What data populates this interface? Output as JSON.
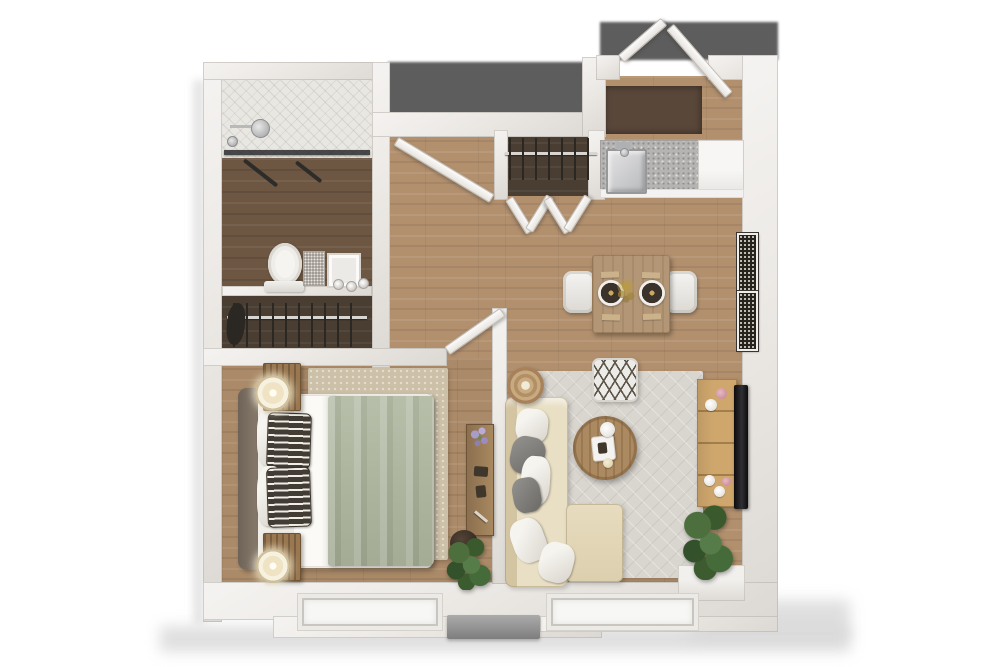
{
  "canvas": {
    "width": 1000,
    "height": 667,
    "background": "#ffffff"
  },
  "plan_type": "one-bedroom-apartment-3d-floor-plan",
  "rooms": [
    "bathroom",
    "bathroom-closet",
    "hallway",
    "entry",
    "kitchen",
    "dining-area",
    "living-room",
    "bedroom",
    "coat-closet"
  ],
  "palette": {
    "wall": "#eae7e3",
    "floor_wood": "#b2906e",
    "floor_wood_dark": "#6d5743",
    "closet_floor": "#4a3e33",
    "shower_tile": "#e9e7e2",
    "exterior_shadow": "#5d5d5d",
    "rug_living": "#d9d5cf",
    "rug_bedroom": "#cdc0a8",
    "sofa_cream": "#e9dfc4",
    "duvet_sage": "#adb59d",
    "console_tan": "#cfa76d",
    "plant_green": "#4d6f3e",
    "accent_pink": "#c2808f",
    "granite_counter": "#b6b4b2",
    "tv_black": "#0c0c0d"
  },
  "items": [
    {
      "n": "building-shadow-bottom",
      "t": "soft",
      "x": 160,
      "y": 626,
      "w": 690,
      "h": 26
    },
    {
      "n": "building-shadow-right",
      "t": "soft",
      "x": 690,
      "y": 600,
      "w": 160,
      "h": 40
    },
    {
      "n": "building-shadow-left",
      "t": "soft2",
      "x": 193,
      "y": 80,
      "w": 12,
      "h": 545
    },
    {
      "n": "exterior-shadow-notch",
      "t": "shadow-dark",
      "x": 388,
      "y": 62,
      "w": 212,
      "h": 53
    },
    {
      "n": "exterior-shadow-entry",
      "t": "shadow-dark",
      "x": 600,
      "y": 22,
      "w": 178,
      "h": 38
    },
    {
      "n": "hallway-floor",
      "t": "wood",
      "x": 372,
      "y": 130,
      "w": 138,
      "h": 238
    },
    {
      "n": "living-room-floor",
      "t": "wood",
      "x": 505,
      "y": 130,
      "w": 240,
      "h": 472
    },
    {
      "n": "entry-floor",
      "t": "wood",
      "x": 600,
      "y": 76,
      "w": 144,
      "h": 66
    },
    {
      "n": "entry-doormat",
      "t": "mat",
      "x": 604,
      "y": 86,
      "w": 98,
      "h": 48
    },
    {
      "n": "bedroom-floor",
      "t": "wood2",
      "x": 222,
      "y": 358,
      "w": 275,
      "h": 240
    },
    {
      "n": "shower-floor",
      "t": "tile",
      "x": 222,
      "y": 76,
      "w": 150,
      "h": 82
    },
    {
      "n": "bathroom-floor",
      "t": "woodDark",
      "x": 222,
      "y": 158,
      "w": 150,
      "h": 132
    },
    {
      "n": "bathroom-closet-floor",
      "t": "darkfloor",
      "x": 222,
      "y": 294,
      "w": 150,
      "h": 62
    },
    {
      "n": "coat-closet-floor",
      "t": "darkfloor",
      "x": 497,
      "y": 130,
      "w": 103,
      "h": 66
    },
    {
      "n": "living-rug",
      "t": "rug-gray",
      "x": 515,
      "y": 371,
      "w": 188,
      "h": 207
    },
    {
      "n": "bedroom-rug",
      "t": "rug-beige",
      "x": 308,
      "y": 368,
      "w": 140,
      "h": 192
    },
    {
      "n": "wall-left",
      "t": "wall",
      "x": 203,
      "y": 62,
      "w": 19,
      "h": 560
    },
    {
      "n": "wall-top-bathroom",
      "t": "wall",
      "x": 203,
      "y": 62,
      "w": 187,
      "h": 18
    },
    {
      "n": "wall-bathroom-right",
      "t": "wall",
      "x": 372,
      "y": 62,
      "w": 18,
      "h": 306
    },
    {
      "n": "wall-bathroom-closet-divider",
      "t": "wall",
      "x": 222,
      "y": 286,
      "w": 150,
      "h": 10
    },
    {
      "n": "wall-bedroom-top",
      "t": "wall",
      "x": 203,
      "y": 348,
      "w": 244,
      "h": 18
    },
    {
      "n": "wall-hallway-top",
      "t": "wall",
      "x": 372,
      "y": 112,
      "w": 230,
      "h": 25
    },
    {
      "n": "wall-entry-left",
      "t": "wall",
      "x": 582,
      "y": 57,
      "w": 24,
      "h": 80
    },
    {
      "n": "wall-entry-top-a",
      "t": "wall",
      "x": 596,
      "y": 55,
      "w": 24,
      "h": 25
    },
    {
      "n": "wall-entry-top-b",
      "t": "wall",
      "x": 708,
      "y": 55,
      "w": 70,
      "h": 25
    },
    {
      "n": "wall-right",
      "t": "wall",
      "x": 742,
      "y": 55,
      "w": 36,
      "h": 567
    },
    {
      "n": "wall-bottom",
      "t": "wall",
      "x": 203,
      "y": 582,
      "w": 575,
      "h": 38
    },
    {
      "n": "wall-bottom-ext-mid",
      "t": "wall",
      "x": 273,
      "y": 616,
      "w": 329,
      "h": 22
    },
    {
      "n": "wall-bottom-ext-right",
      "t": "wall",
      "x": 540,
      "y": 616,
      "w": 238,
      "h": 16
    },
    {
      "n": "wall-partition-bedroom-living",
      "t": "wall",
      "x": 492,
      "y": 308,
      "w": 15,
      "h": 276
    },
    {
      "n": "wall-coat-closet-left",
      "t": "wall",
      "x": 494,
      "y": 130,
      "w": 14,
      "h": 70
    },
    {
      "n": "wall-coat-closet-right",
      "t": "wall",
      "x": 588,
      "y": 130,
      "w": 17,
      "h": 70
    },
    {
      "n": "shower-glass-panel",
      "t": "glass-dark",
      "x": 224,
      "y": 150,
      "w": 146,
      "h": 5
    },
    {
      "n": "shower-squeegee-a",
      "t": "bar-dark",
      "x": 244,
      "y": 158,
      "w": 42,
      "h": 4,
      "r": 38
    },
    {
      "n": "shower-squeegee-b",
      "t": "bar-dark",
      "x": 296,
      "y": 160,
      "w": 32,
      "h": 4,
      "r": 38
    },
    {
      "n": "shower-arm",
      "t": "steel-line",
      "x": 230,
      "y": 125,
      "w": 26,
      "h": 3
    },
    {
      "n": "shower-head",
      "t": "steel-round",
      "x": 251,
      "y": 119,
      "w": 17,
      "h": 17
    },
    {
      "n": "shower-valve",
      "t": "steel-round",
      "x": 227,
      "y": 136,
      "w": 9,
      "h": 9
    },
    {
      "n": "toilet-bowl",
      "t": "toilet-bowl",
      "x": 268,
      "y": 243,
      "w": 34,
      "h": 42
    },
    {
      "n": "toilet-tank",
      "t": "toilet-tank",
      "x": 264,
      "y": 281,
      "w": 40,
      "h": 11
    },
    {
      "n": "vanity-mirror",
      "t": "sparkle",
      "x": 303,
      "y": 251,
      "w": 20,
      "h": 33
    },
    {
      "n": "vanity-frame",
      "t": "frame-white",
      "x": 327,
      "y": 253,
      "w": 30,
      "h": 31
    },
    {
      "n": "sink-knob-1",
      "t": "knob",
      "x": 333,
      "y": 279,
      "w": 9,
      "h": 9
    },
    {
      "n": "sink-knob-2",
      "t": "knob",
      "x": 346,
      "y": 281,
      "w": 9,
      "h": 9
    },
    {
      "n": "sink-knob-3",
      "t": "knob",
      "x": 358,
      "y": 278,
      "w": 9,
      "h": 9
    },
    {
      "n": "bathroom-closet-rod",
      "t": "rod",
      "x": 227,
      "y": 316,
      "w": 140,
      "h": 3
    },
    {
      "n": "bathroom-closet-hangers",
      "t": "hangers",
      "x": 233,
      "y": 303,
      "w": 128,
      "h": 44
    },
    {
      "n": "bathroom-closet-clothes",
      "t": "clothes-dark",
      "x": 227,
      "y": 302,
      "w": 18,
      "h": 42,
      "r": 6
    },
    {
      "n": "coat-closet-rod",
      "t": "rod",
      "x": 505,
      "y": 152,
      "w": 92,
      "h": 3
    },
    {
      "n": "coat-closet-hangers",
      "t": "hangers",
      "x": 509,
      "y": 138,
      "w": 86,
      "h": 42
    },
    {
      "n": "bifold-door-a1",
      "t": "door",
      "x": 509,
      "y": 194,
      "w": 38,
      "h": 7,
      "r": 58
    },
    {
      "n": "bifold-door-a2",
      "t": "door",
      "x": 529,
      "y": 226,
      "w": 38,
      "h": 7,
      "r": -58
    },
    {
      "n": "bifold-door-b1",
      "t": "door",
      "x": 547,
      "y": 194,
      "w": 38,
      "h": 7,
      "r": 58
    },
    {
      "n": "bifold-door-b2",
      "t": "door",
      "x": 567,
      "y": 226,
      "w": 38,
      "h": 7,
      "r": -58
    },
    {
      "n": "kitchen-counter-granite",
      "t": "granite",
      "x": 600,
      "y": 140,
      "w": 100,
      "h": 54
    },
    {
      "n": "kitchen-cabinet-white",
      "t": "cab-white",
      "x": 698,
      "y": 140,
      "w": 44,
      "h": 54
    },
    {
      "n": "kitchen-counter-lip",
      "t": "lip",
      "x": 600,
      "y": 189,
      "w": 142,
      "h": 7
    },
    {
      "n": "kitchen-sink",
      "t": "sink",
      "x": 606,
      "y": 149,
      "w": 37,
      "h": 41
    },
    {
      "n": "kitchen-faucet",
      "t": "faucet",
      "x": 616,
      "y": 142,
      "w": 14,
      "h": 8
    },
    {
      "n": "kitchen-faucet-knob",
      "t": "steel-round",
      "x": 620,
      "y": 148,
      "w": 7,
      "h": 7
    },
    {
      "n": "entry-door-left",
      "t": "door",
      "x": 621,
      "y": 54,
      "w": 55,
      "h": 8,
      "r": -41
    },
    {
      "n": "entry-door-right",
      "t": "door",
      "x": 670,
      "y": 22,
      "w": 88,
      "h": 8,
      "r": 49
    },
    {
      "n": "bathroom-door",
      "t": "door",
      "x": 396,
      "y": 136,
      "w": 110,
      "h": 8,
      "r": 31
    },
    {
      "n": "bedroom-door",
      "t": "door",
      "x": 447,
      "y": 346,
      "w": 66,
      "h": 8,
      "r": -35
    },
    {
      "n": "dining-chair-left",
      "t": "chair",
      "x": 563,
      "y": 271,
      "w": 32,
      "h": 42
    },
    {
      "n": "dining-chair-right",
      "t": "chair",
      "x": 665,
      "y": 271,
      "w": 32,
      "h": 42
    },
    {
      "n": "dining-table",
      "t": "table-wood",
      "x": 592,
      "y": 255,
      "w": 78,
      "h": 78
    },
    {
      "n": "placemat-1",
      "t": "placemat",
      "x": 601,
      "y": 272,
      "w": 18,
      "h": 6,
      "r": -2
    },
    {
      "n": "placemat-2",
      "t": "placemat",
      "x": 642,
      "y": 272,
      "w": 18,
      "h": 6,
      "r": 2
    },
    {
      "n": "placemat-3",
      "t": "placemat",
      "x": 602,
      "y": 314,
      "w": 18,
      "h": 6,
      "r": 2
    },
    {
      "n": "placemat-4",
      "t": "placemat",
      "x": 643,
      "y": 314,
      "w": 18,
      "h": 6,
      "r": -2
    },
    {
      "n": "dinner-plate-1",
      "t": "plate",
      "x": 598,
      "y": 280,
      "w": 26,
      "h": 26
    },
    {
      "n": "dinner-plate-2",
      "t": "plate",
      "x": 639,
      "y": 280,
      "w": 26,
      "h": 26
    },
    {
      "n": "table-centerpiece",
      "t": "sprig",
      "x": 616,
      "y": 277,
      "w": 20,
      "h": 28
    },
    {
      "n": "wall-art-upper",
      "t": "art",
      "x": 737,
      "y": 233,
      "w": 17,
      "h": 55
    },
    {
      "n": "wall-art-lower",
      "t": "art",
      "x": 737,
      "y": 291,
      "w": 17,
      "h": 56
    },
    {
      "n": "floor-pouf",
      "t": "pouf",
      "x": 592,
      "y": 358,
      "w": 42,
      "h": 40
    },
    {
      "n": "sofa-base",
      "t": "sofa",
      "x": 505,
      "y": 397,
      "w": 63,
      "h": 190
    },
    {
      "n": "sofa-chaise",
      "t": "chaise",
      "x": 566,
      "y": 504,
      "w": 57,
      "h": 78
    },
    {
      "n": "side-table",
      "t": "side-table",
      "x": 507,
      "y": 367,
      "w": 37,
      "h": 37
    },
    {
      "n": "sofa-pillow-white-1",
      "t": "pillow-white",
      "x": 516,
      "y": 407,
      "w": 32,
      "h": 34,
      "r": 6
    },
    {
      "n": "sofa-pillow-gray-1",
      "t": "pillow-gray",
      "x": 511,
      "y": 433,
      "w": 34,
      "h": 38,
      "r": 12
    },
    {
      "n": "sofa-pillow-white-2",
      "t": "pillow-white",
      "x": 521,
      "y": 455,
      "w": 29,
      "h": 49,
      "r": 4
    },
    {
      "n": "sofa-pillow-gray-2",
      "t": "pillow-gray",
      "x": 513,
      "y": 480,
      "w": 28,
      "h": 35,
      "r": -10
    },
    {
      "n": "sofa-pillow-white-3",
      "t": "pillow-white",
      "x": 513,
      "y": 524,
      "w": 33,
      "h": 44,
      "r": -20
    },
    {
      "n": "sofa-pillow-white-4",
      "t": "pillow-white",
      "x": 540,
      "y": 538,
      "w": 34,
      "h": 40,
      "r": 15
    },
    {
      "n": "coffee-table",
      "t": "coffee",
      "x": 573,
      "y": 416,
      "w": 64,
      "h": 64
    },
    {
      "n": "coffee-table-tray",
      "t": "tray",
      "x": 592,
      "y": 437,
      "w": 21,
      "h": 23,
      "r": -6
    },
    {
      "n": "tray-teapot",
      "t": "item-dark",
      "x": 598,
      "y": 443,
      "w": 9,
      "h": 11,
      "r": -6
    },
    {
      "n": "coffee-table-plate",
      "t": "circle-white",
      "x": 600,
      "y": 422,
      "w": 15,
      "h": 15
    },
    {
      "n": "coffee-table-candle",
      "t": "circle-cream",
      "x": 603,
      "y": 458,
      "w": 10,
      "h": 10
    },
    {
      "n": "media-console",
      "t": "console",
      "x": 697,
      "y": 379,
      "w": 38,
      "h": 126
    },
    {
      "n": "tv",
      "t": "tv",
      "x": 734,
      "y": 385,
      "w": 14,
      "h": 124
    },
    {
      "n": "console-vase-pink-1",
      "t": "deco-pink",
      "x": 716,
      "y": 388,
      "w": 11,
      "h": 11
    },
    {
      "n": "console-bowl-white",
      "t": "circle-white",
      "x": 705,
      "y": 399,
      "w": 12,
      "h": 12
    },
    {
      "n": "console-orb-white-1",
      "t": "circle-white",
      "x": 704,
      "y": 475,
      "w": 11,
      "h": 11
    },
    {
      "n": "console-orb-white-2",
      "t": "circle-white",
      "x": 714,
      "y": 486,
      "w": 11,
      "h": 11
    },
    {
      "n": "console-vase-pink-2",
      "t": "deco-pink",
      "x": 722,
      "y": 477,
      "w": 9,
      "h": 9
    },
    {
      "n": "corner-ledge",
      "t": "ledge",
      "x": 678,
      "y": 565,
      "w": 67,
      "h": 36
    },
    {
      "n": "living-plant",
      "t": "plant",
      "x": 682,
      "y": 504,
      "w": 52,
      "h": 76
    },
    {
      "n": "bed-headboard",
      "t": "headboard",
      "x": 238,
      "y": 388,
      "w": 24,
      "h": 182
    },
    {
      "n": "bed-mattress",
      "t": "mattress",
      "x": 258,
      "y": 394,
      "w": 174,
      "h": 174
    },
    {
      "n": "bed-sheet",
      "t": "sheet",
      "x": 294,
      "y": 396,
      "w": 42,
      "h": 170
    },
    {
      "n": "bed-duvet",
      "t": "duvet",
      "x": 328,
      "y": 396,
      "w": 106,
      "h": 170
    },
    {
      "n": "bed-pillow-white-1",
      "t": "pillow-white",
      "x": 257,
      "y": 408,
      "w": 26,
      "h": 58
    },
    {
      "n": "bed-pillow-striped-1",
      "t": "pillow-stripe",
      "x": 267,
      "y": 412,
      "w": 42,
      "h": 54,
      "r": 2
    },
    {
      "n": "bed-pillow-white-2",
      "t": "pillow-white",
      "x": 257,
      "y": 466,
      "w": 26,
      "h": 60
    },
    {
      "n": "bed-pillow-striped-2",
      "t": "pillow-stripe",
      "x": 267,
      "y": 468,
      "w": 42,
      "h": 58,
      "r": -2
    },
    {
      "n": "nightstand-upper",
      "t": "nightstand",
      "x": 263,
      "y": 363,
      "w": 36,
      "h": 46
    },
    {
      "n": "table-lamp-upper",
      "t": "lamp",
      "x": 255,
      "y": 375,
      "w": 36,
      "h": 36
    },
    {
      "n": "nightstand-lower",
      "t": "nightstand",
      "x": 263,
      "y": 533,
      "w": 36,
      "h": 46
    },
    {
      "n": "table-lamp-lower",
      "t": "lamp",
      "x": 256,
      "y": 549,
      "w": 34,
      "h": 34
    },
    {
      "n": "bedroom-desk",
      "t": "wood-strip",
      "x": 466,
      "y": 424,
      "w": 26,
      "h": 110
    },
    {
      "n": "desk-flowers",
      "t": "flowers",
      "x": 467,
      "y": 425,
      "w": 25,
      "h": 27
    },
    {
      "n": "desk-item-1",
      "t": "item-dark",
      "x": 474,
      "y": 466,
      "w": 14,
      "h": 10,
      "r": 4
    },
    {
      "n": "desk-item-2",
      "t": "item-dark",
      "x": 476,
      "y": 486,
      "w": 10,
      "h": 12,
      "r": -6
    },
    {
      "n": "desk-pen",
      "t": "pen",
      "x": 475,
      "y": 510,
      "w": 16,
      "h": 3,
      "r": 40
    },
    {
      "n": "bedroom-plant-pot",
      "t": "pot",
      "x": 450,
      "y": 530,
      "w": 28,
      "h": 26
    },
    {
      "n": "bedroom-plant",
      "t": "plant",
      "x": 444,
      "y": 538,
      "w": 50,
      "h": 52
    },
    {
      "n": "bedroom-window",
      "t": "window",
      "x": 298,
      "y": 594,
      "w": 136,
      "h": 28
    },
    {
      "n": "living-window",
      "t": "window",
      "x": 547,
      "y": 594,
      "w": 143,
      "h": 28
    },
    {
      "n": "exterior-unit-ledge",
      "t": "gray-block",
      "x": 447,
      "y": 615,
      "w": 93,
      "h": 24
    }
  ]
}
